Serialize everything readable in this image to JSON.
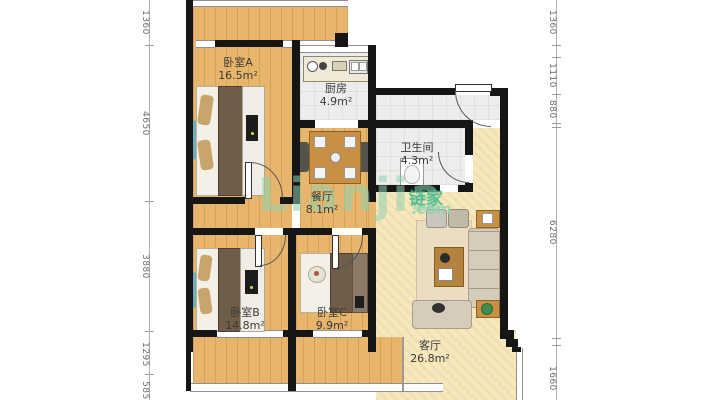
{
  "plan": {
    "rooms": [
      {
        "id": "bedroom-a",
        "name": "卧室A",
        "area": "16.5m²"
      },
      {
        "id": "kitchen",
        "name": "厨房",
        "area": "4.9m²"
      },
      {
        "id": "bathroom",
        "name": "卫生间",
        "area": "4.3m²"
      },
      {
        "id": "dining",
        "name": "餐厅",
        "area": "8.1m²"
      },
      {
        "id": "bedroom-b",
        "name": "卧室B",
        "area": "14.8m²"
      },
      {
        "id": "bedroom-c",
        "name": "卧室C",
        "area": "9.9m²"
      },
      {
        "id": "living",
        "name": "客厅",
        "area": "26.8m²"
      }
    ],
    "dimensions_left": [
      "1360",
      "4650",
      "3880",
      "1295",
      "585"
    ],
    "dimensions_right": [
      "1360",
      "1110",
      "880",
      "6280",
      "1660"
    ],
    "watermark": {
      "latin": "Lianjia",
      "cjk": "链家",
      "tld": ".com"
    },
    "palette": {
      "wall": "#161616",
      "wood_floor": "#e8b56c",
      "carpet_floor": "#f6e7bd",
      "tile_floor": "#ededeb",
      "watermark_green": "#8ed1ae",
      "watermark_green_dark": "#3bb586"
    }
  }
}
